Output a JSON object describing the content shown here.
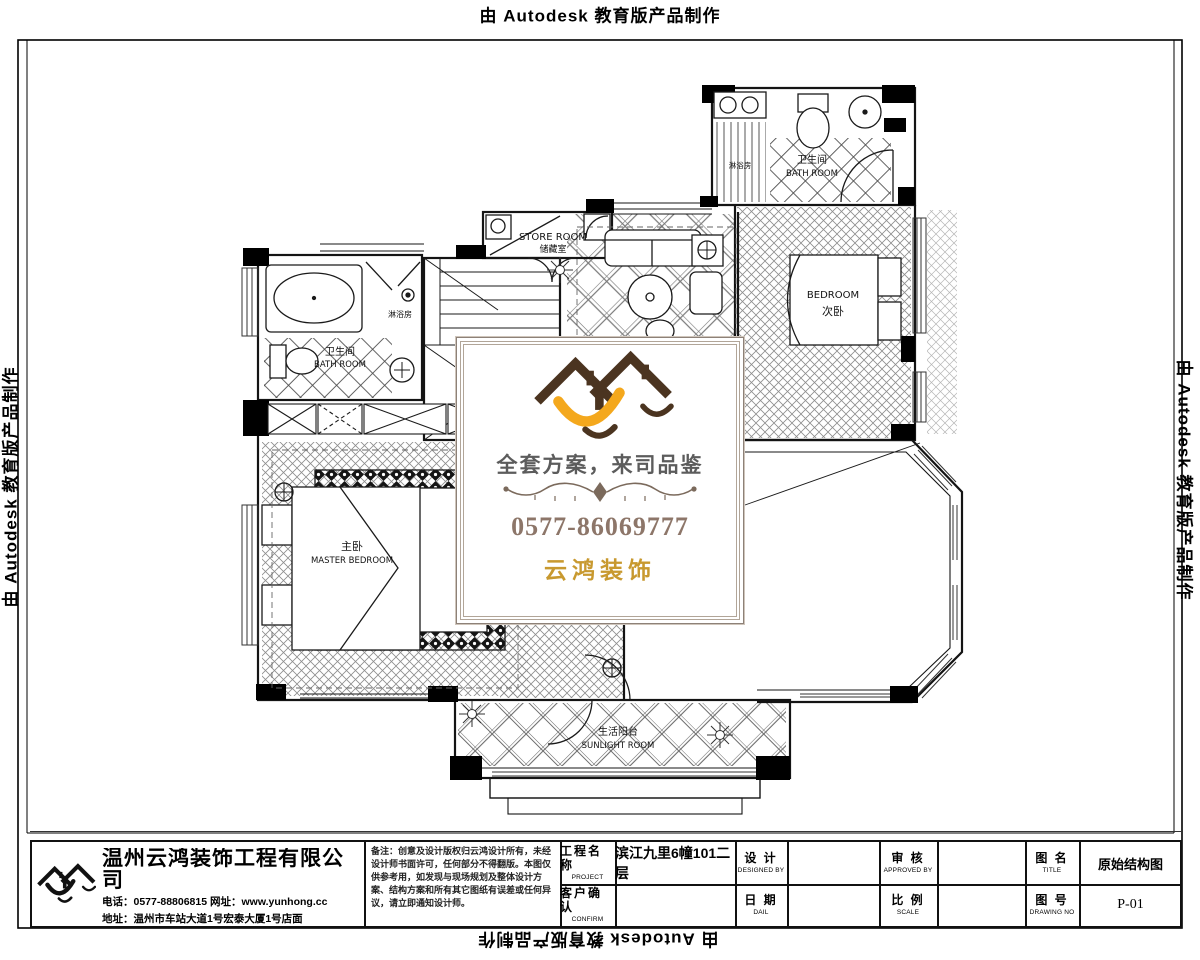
{
  "autodesk_notice": "由 Autodesk 教育版产品制作",
  "plan": {
    "rooms": {
      "store": {
        "en": "STORE ROOM",
        "zh": "储藏室"
      },
      "bath2": {
        "zh": "卫生间",
        "en": "BATH ROOM"
      },
      "shower2": {
        "zh": "淋浴房"
      },
      "bedroom2": {
        "en": "BEDROOM",
        "zh": "次卧"
      },
      "bath1": {
        "zh": "卫生间",
        "en": "BATH ROOM"
      },
      "shower1": {
        "zh": "淋浴房"
      },
      "master": {
        "zh": "主卧",
        "en": "MASTER BEDROOM"
      },
      "sunroom": {
        "zh": "生活阳台",
        "en": "SUNLIGHT ROOM"
      }
    }
  },
  "overlay": {
    "slogan": "全套方案，来司品鉴",
    "phone": "0577-86069777",
    "brand": "云鸿装饰",
    "colors": {
      "roof": "#4b3420",
      "gold": "#f4a81d",
      "brand_gold": "#c8992f",
      "phone_brown": "#8d7669",
      "frame": "#8d8178"
    }
  },
  "titleblock": {
    "company": "温州云鸿装饰工程有限公司",
    "contact": "电话：0577-88806815 网址：www.yunhong.cc",
    "address": "地址：温州市车站大道1号宏泰大厦1号店面",
    "notes": "备注：创意及设计版权归云鸿设计所有，未经设计师书面许可，任何部分不得翻版。本图仅供参考用，如发现与现场规划及整体设计方案、结构方案和所有其它图纸有误差或任何异议，请立即通知设计师。",
    "project": {
      "zh": "工程名称",
      "en": "PROJECT",
      "value": "滨江九里6幢101二层"
    },
    "design": {
      "zh": "设 计",
      "en": "DESIGNED BY",
      "value": ""
    },
    "confirm": {
      "zh": "客户确认",
      "en": "CONFIRM",
      "value": ""
    },
    "date": {
      "zh": "日 期",
      "en": "DAIL",
      "value": ""
    },
    "approve": {
      "zh": "审 核",
      "en": "APPROVED BY",
      "value": ""
    },
    "scale": {
      "zh": "比 例",
      "en": "SCALE",
      "value": ""
    },
    "title": {
      "zh": "图 名",
      "en": "TITLE",
      "value": "原始结构图"
    },
    "no": {
      "zh": "图 号",
      "en": "DRAWING NO",
      "value": "P-01"
    }
  }
}
